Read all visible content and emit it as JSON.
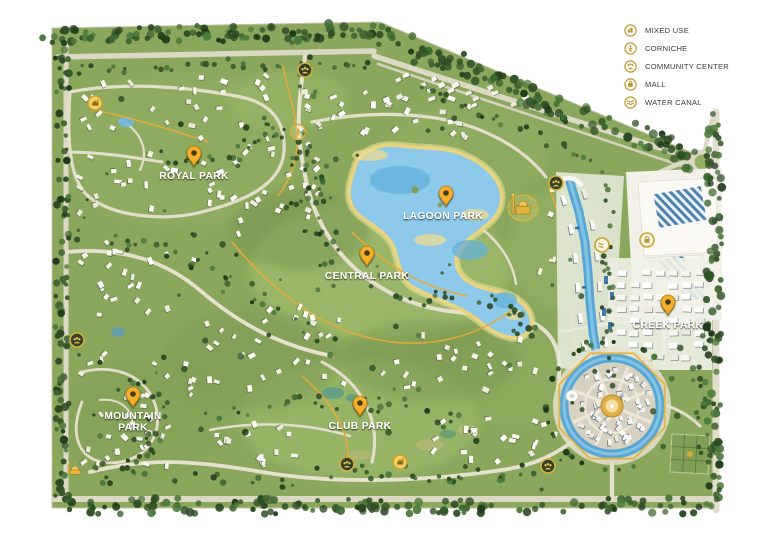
{
  "legend": {
    "items": [
      {
        "id": "mixed-use",
        "label": "MIXED USE"
      },
      {
        "id": "corniche",
        "label": "CORNICHE"
      },
      {
        "id": "community-center",
        "label": "COMMUNITY CENTER"
      },
      {
        "id": "mall",
        "label": "MALL"
      },
      {
        "id": "water-canal",
        "label": "WATER CANAL"
      }
    ]
  },
  "parks": [
    {
      "name": "ROYAL PARK",
      "pin_x": 194,
      "pin_y": 166
    },
    {
      "name": "LAGOON PARK",
      "pin_x": 446,
      "pin_y": 206
    },
    {
      "name": "CENTRAL PARK",
      "pin_x": 367,
      "pin_y": 266
    },
    {
      "name": "CREEK PARK",
      "pin_x": 668,
      "pin_y": 315
    },
    {
      "name": "MOUNTAIN PARK",
      "lines": [
        "MOUNTAIN",
        "PARK"
      ],
      "pin_x": 133,
      "pin_y": 407
    },
    {
      "name": "CLUB PARK",
      "pin_x": 360,
      "pin_y": 416
    }
  ],
  "map_markers": [
    {
      "type": "mosque",
      "x": 95,
      "y": 103
    },
    {
      "type": "community-center",
      "x": 305,
      "y": 70
    },
    {
      "type": "corniche",
      "x": 298,
      "y": 132
    },
    {
      "type": "community-center",
      "x": 556,
      "y": 183
    },
    {
      "type": "water-canal",
      "x": 602,
      "y": 245
    },
    {
      "type": "mall",
      "x": 647,
      "y": 240
    },
    {
      "type": "community-center",
      "x": 77,
      "y": 340
    },
    {
      "type": "mosque-silhouette",
      "x": 75,
      "y": 470
    },
    {
      "type": "community-center",
      "x": 347,
      "y": 464
    },
    {
      "type": "mosque",
      "x": 400,
      "y": 462
    },
    {
      "type": "community-center",
      "x": 548,
      "y": 466
    }
  ],
  "colors": {
    "gold": "#D5A93E",
    "pin_gold": "#F4B02A",
    "lagoon_water": "#8CC9EA",
    "canal_water": "#58A6D6",
    "sand": "#E9D480",
    "green_base": "#8AA85C",
    "legend_text": "#3C3C3B",
    "label_text": "#FFFFFF"
  }
}
